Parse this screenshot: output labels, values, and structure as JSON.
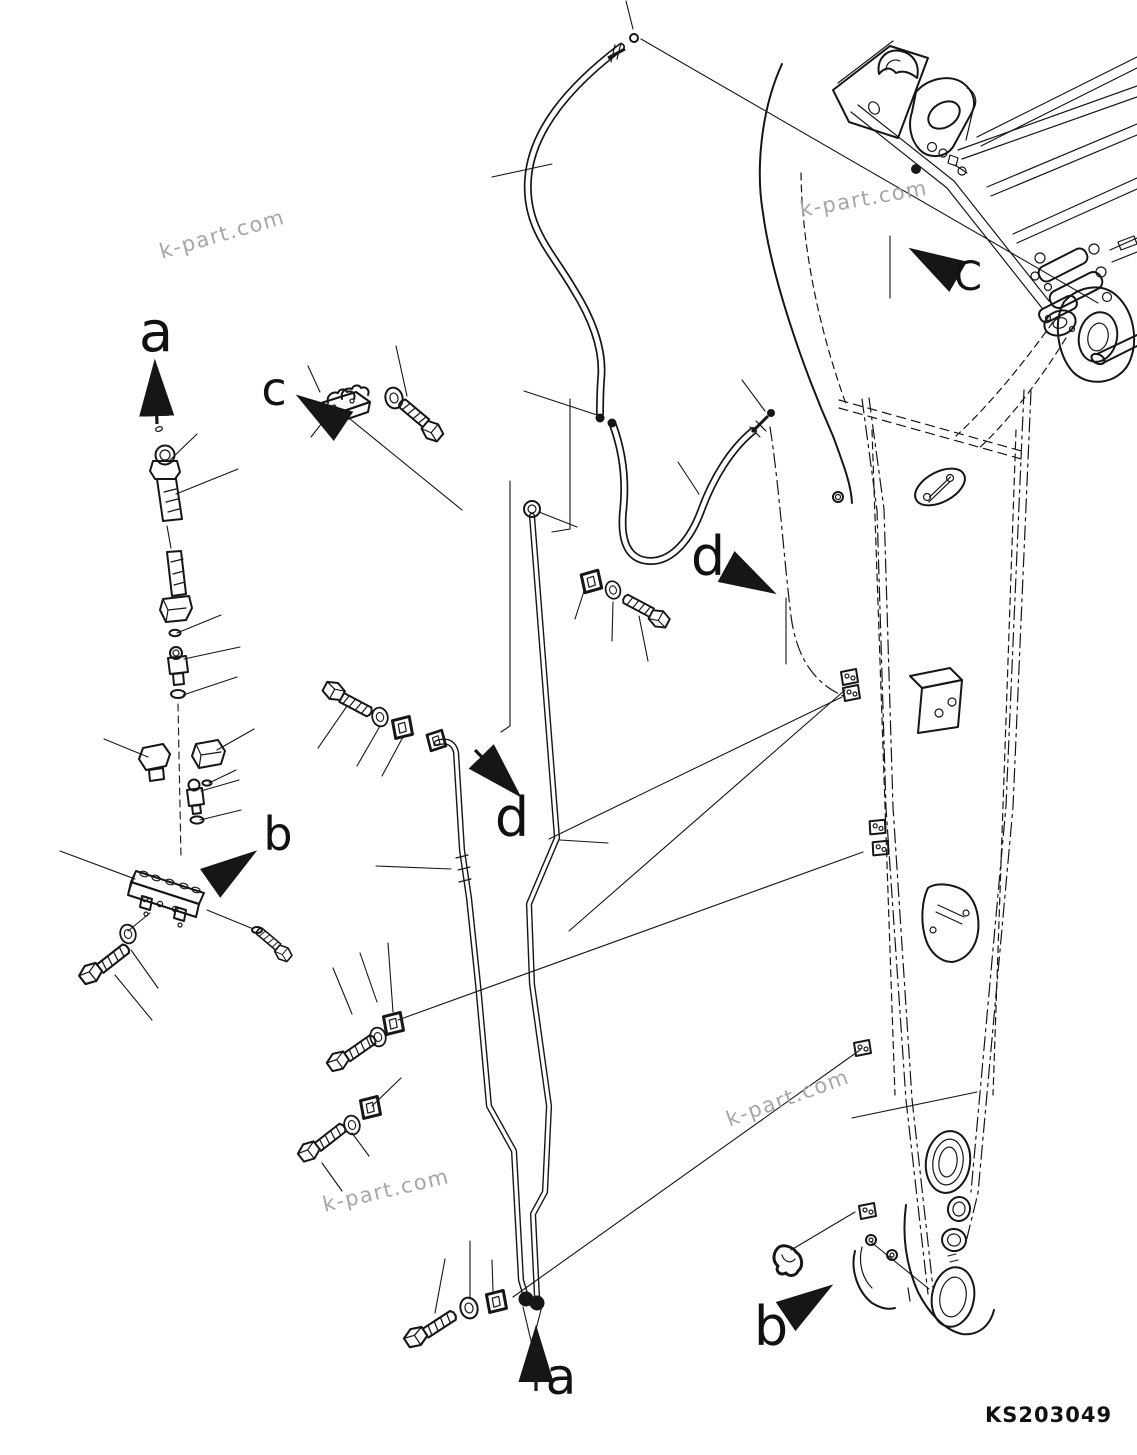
{
  "page": {
    "background": "#ffffff",
    "line_color": "#161616"
  },
  "drawing_number": "KS203049",
  "watermark": {
    "text": "k-part.com",
    "color": "#a6a6a6"
  },
  "view_labels": {
    "a_top": "a",
    "c_upper": "c",
    "C_machine": "C",
    "d_upper": "d",
    "d_lower": "d",
    "b_manifold": "b",
    "b_arm": "b",
    "a_bottom": "a"
  }
}
